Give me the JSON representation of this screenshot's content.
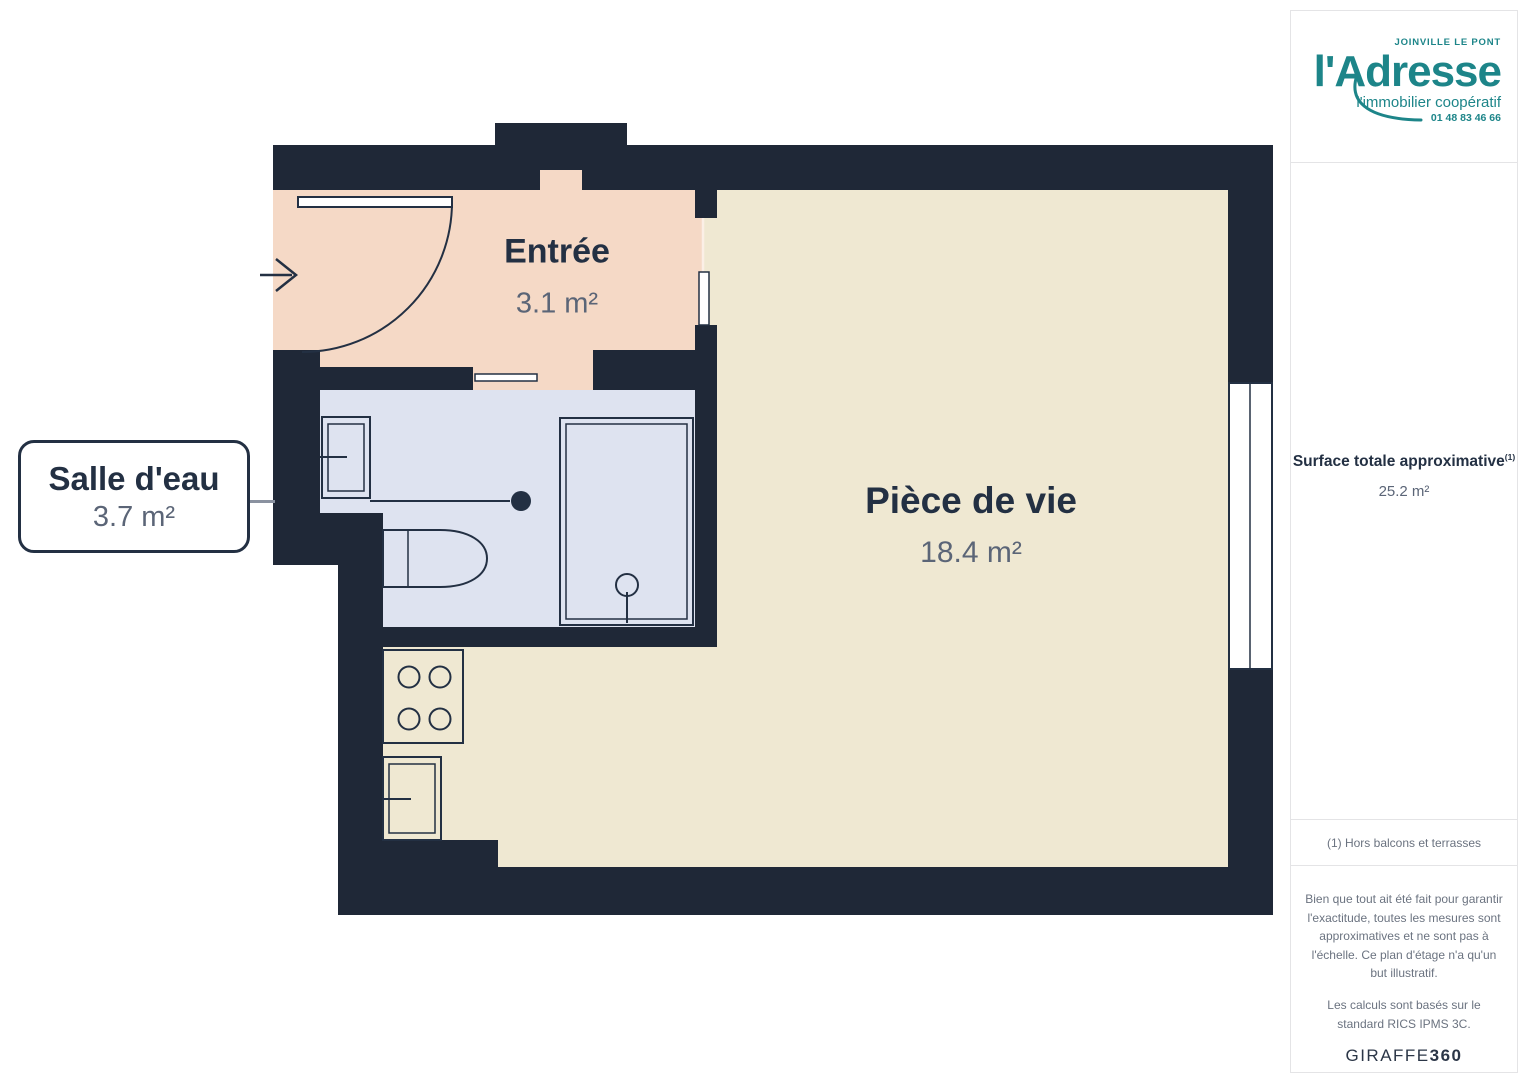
{
  "plan": {
    "rooms": {
      "entree": {
        "name": "Entrée",
        "area": "3.1 m²"
      },
      "bathroom": {
        "name": "Salle d'eau",
        "area": "3.7 m²"
      },
      "living": {
        "name": "Pièce de vie",
        "area": "18.4 m²"
      }
    },
    "colors": {
      "wall": "#1F2837",
      "entree": "#F5D9C6",
      "bath": "#DEE3F0",
      "living": "#EFE8D2",
      "ink": "#233043",
      "muted": "#5B6577",
      "connector": "#8A92A0",
      "accent": "#1D8589"
    }
  },
  "sidebar": {
    "logo": {
      "city": "JOINVILLE LE PONT",
      "brand": "l'Adresse",
      "tagline": "l'immobilier coopératif",
      "phone": "01 48 83 46 66"
    },
    "surface": {
      "label": "Surface totale approximative",
      "footnote_marker": "(1)",
      "value": "25.2 m²"
    },
    "footnote": "(1) Hors balcons et terrasses",
    "disclaimer_1": "Bien que tout ait été fait pour garantir l'exactitude, toutes les mesures sont approximatives et ne sont pas à l'échelle. Ce plan d'étage n'a qu'un but illustratif.",
    "disclaimer_2": "Les calculs sont basés sur le standard RICS IPMS 3C.",
    "brand_mark": {
      "name": "GIRAFFE",
      "number": "360"
    }
  }
}
